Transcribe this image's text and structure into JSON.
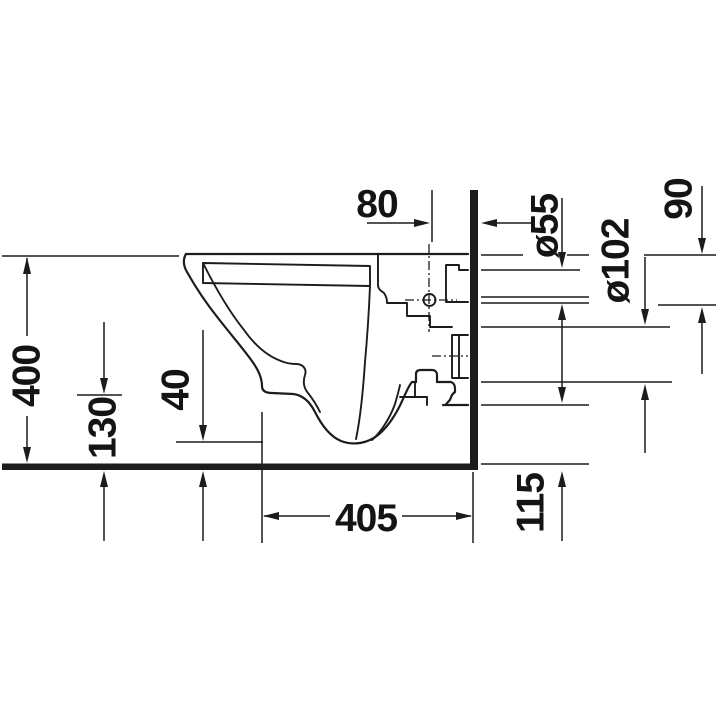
{
  "drawing": {
    "type": "product-dimension-drawing",
    "subject": "wall-hung-toilet-side-section",
    "colors": {
      "line": "#1c1c1c",
      "background": "#ffffff"
    },
    "dims": {
      "wall_offset": "80",
      "supply_pipe_diameter": "ø55",
      "supply_drop": "90",
      "outlet_pipe_diameter": "ø102",
      "rim_height": "400",
      "front_underside_height": "130",
      "trap_clearance": "40",
      "depth": "405",
      "outlet_bottom_height": "115"
    }
  }
}
